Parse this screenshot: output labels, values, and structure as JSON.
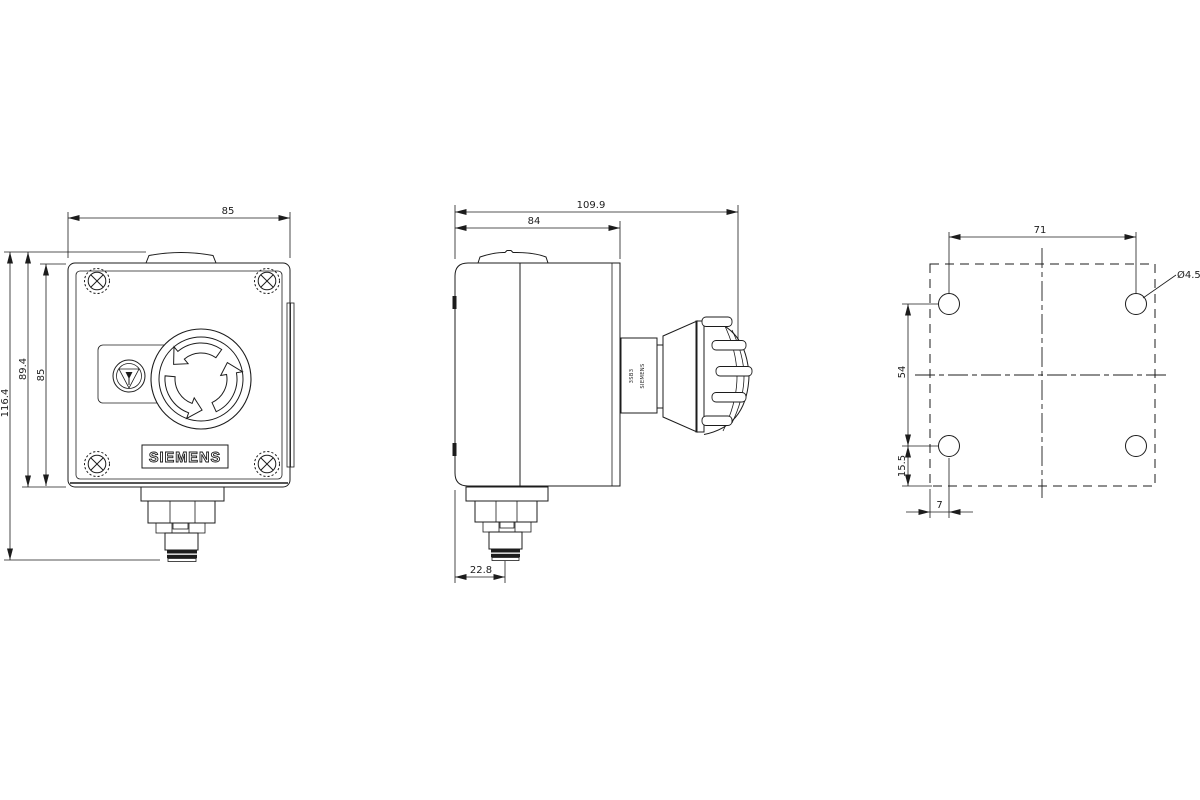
{
  "drawing": {
    "colors": {
      "line": "#1c1c1c",
      "background": "#ffffff"
    },
    "front_view": {
      "dim_width_top": "85",
      "dim_height_total": "116.4",
      "dim_height_box_with_cap": "89.4",
      "dim_height_box": "85",
      "brand_label": "SIEMENS"
    },
    "side_view": {
      "dim_depth_total": "109.9",
      "dim_depth_box": "84",
      "dim_gland_offset": "22.8",
      "button_marking_line1": "3SB3",
      "button_marking_line2": "SIEMENS"
    },
    "drill_view": {
      "dim_hole_spacing_horizontal": "71",
      "dim_hole_spacing_vertical": "54",
      "dim_hole_to_bottom_edge": "15.5",
      "dim_hole_to_side_edge": "7",
      "dim_hole_diameter": "Ø4.5"
    }
  }
}
